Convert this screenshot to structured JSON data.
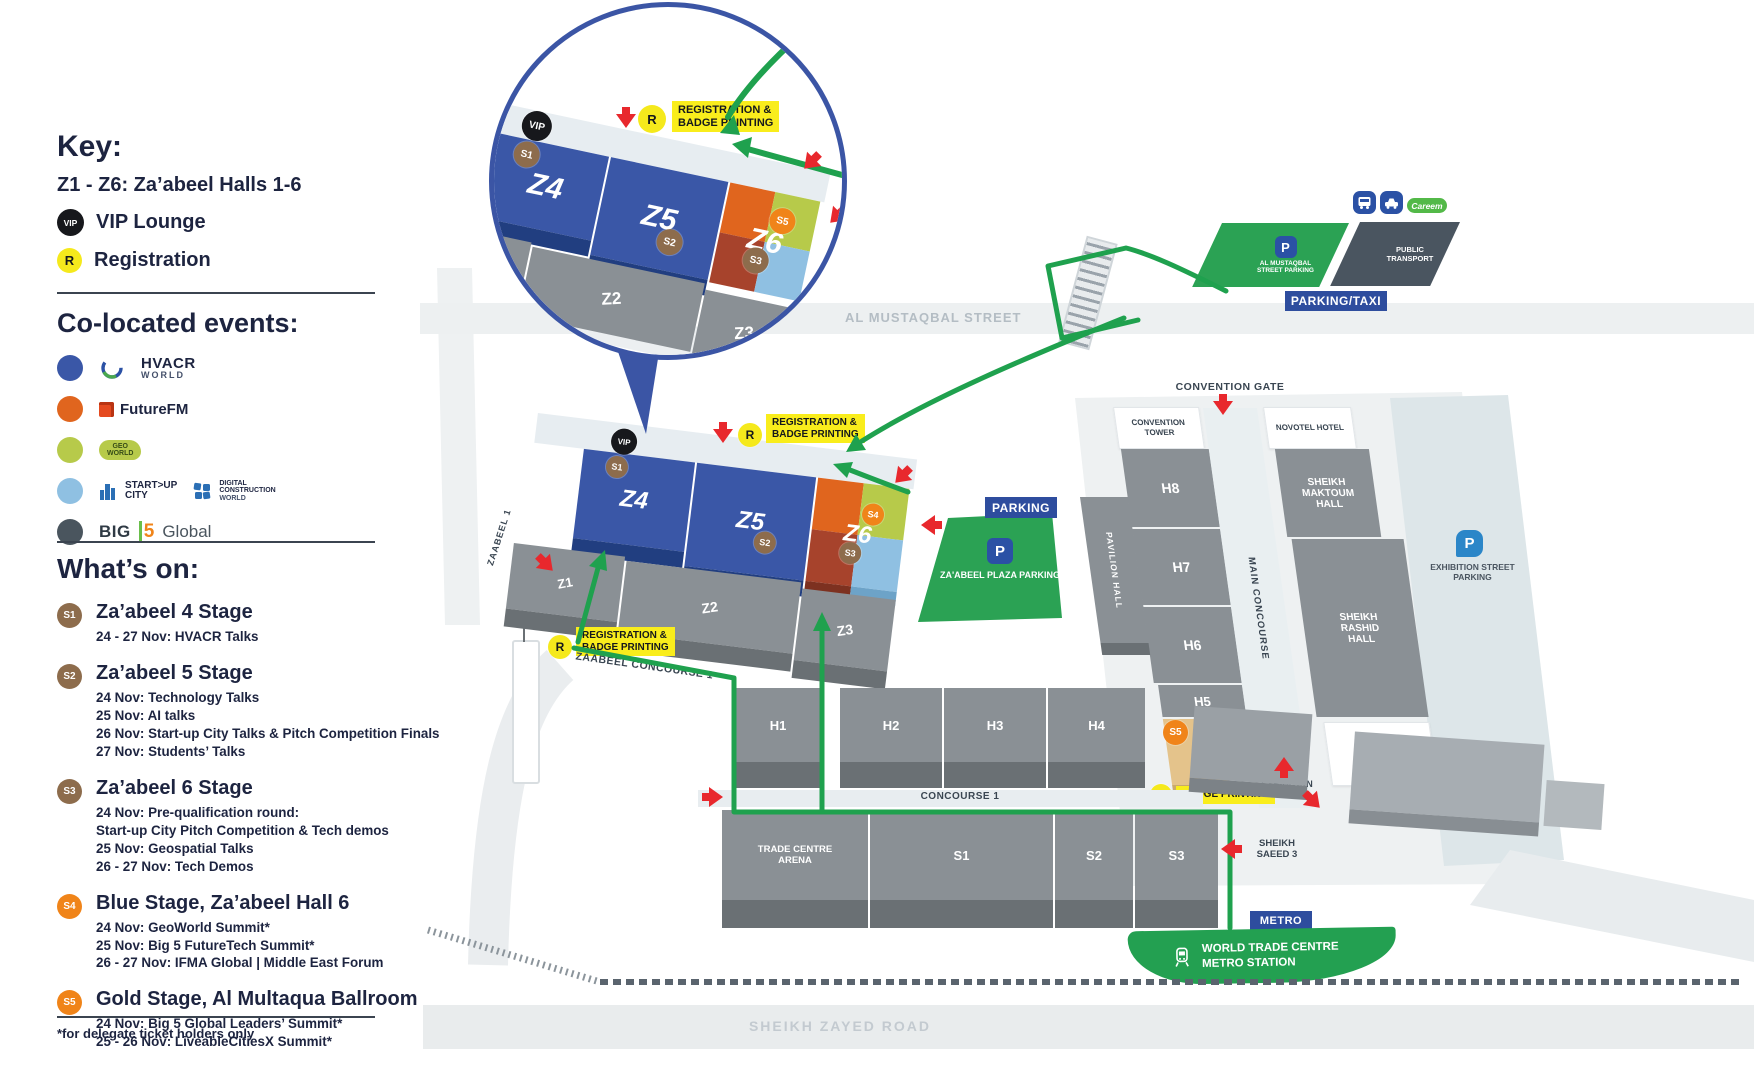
{
  "badges": {
    "vip": "VIP",
    "r": "R",
    "s1": "S1",
    "s2": "S2",
    "s3": "S3",
    "s4": "S4",
    "s5": "S5"
  },
  "colors": {
    "route_green": "#1fa14e",
    "label_yellow": "#f9ed1c",
    "label_blue": "#2e4d9e",
    "hall_blue": "#3a57a7",
    "hall_orange": "#e0651e",
    "hall_lime": "#b7ca4a",
    "hall_rust": "#a7432c",
    "hall_lightblue": "#8fc0e2",
    "hall_gray": "#8a9095",
    "stage_brown": "#8d6c4c",
    "stage_orange": "#f08419",
    "parking_green": "#2ba254"
  },
  "sidebar": {
    "key_title": "Key:",
    "halls_line": "Z1 - Z6:  Za’abeel Halls 1-6",
    "vip_label": "VIP Lounge",
    "registration_label": "Registration",
    "colocated_title": "Co-located events:",
    "events": [
      {
        "id": "hvacr-world",
        "dot": "#3a57a7",
        "line1": "HVACR",
        "line2": "WORLD"
      },
      {
        "id": "futurefm",
        "dot": "#e0651e",
        "line1": "FutureFM"
      },
      {
        "id": "geoworld",
        "dot": "#b7ca4a",
        "line1": "GEO",
        "line2": "WORLD"
      },
      {
        "id": "startup-city-dcw",
        "dot": "#8fc0e2",
        "a1": "START>UP",
        "a2": "CITY",
        "b1": "DIGITAL",
        "b2": "CONSTRUCTION",
        "b3": "WORLD"
      },
      {
        "id": "big5-global",
        "dot": "#4a555e",
        "p1": "BIG",
        "p2": "5",
        "p3": "Global"
      }
    ],
    "whats_on_title": "What’s on:",
    "stages": [
      {
        "badge": "S1",
        "color": "#8d6c4c",
        "title": "Za’abeel 4 Stage",
        "lines": [
          "24 - 27 Nov: HVACR Talks"
        ]
      },
      {
        "badge": "S2",
        "color": "#8d6c4c",
        "title": "Za’abeel 5 Stage",
        "lines": [
          "24 Nov: Technology Talks",
          "25 Nov: AI talks",
          "26 Nov: Start-up City Talks & Pitch Competition Finals",
          "27 Nov: Students’ Talks"
        ]
      },
      {
        "badge": "S3",
        "color": "#8d6c4c",
        "title": "Za’abeel 6 Stage",
        "lines": [
          "24 Nov: Pre-qualification round:",
          "Start-up City Pitch Competition & Tech demos",
          "25 Nov: Geospatial Talks",
          "26 - 27 Nov: Tech Demos"
        ]
      },
      {
        "badge": "S4",
        "color": "#f08419",
        "title": "Blue Stage, Za’abeel Hall 6",
        "lines": [
          "24 Nov: GeoWorld Summit*",
          "25 Nov: Big 5 FutureTech Summit*",
          "26 - 27 Nov: IFMA Global | Middle East Forum"
        ]
      },
      {
        "badge": "S5",
        "color": "#f08419",
        "title": "Gold Stage, Al Multaqua Ballroom",
        "lines": [
          "24 Nov: Big 5 Global Leaders’ Summit*",
          "25 - 26 Nov: LiveableCitiesX Summit*"
        ]
      }
    ],
    "footnote": "*for delegate ticket holders only"
  },
  "map": {
    "streets": {
      "al_mustaqbal": "AL MUSTAQBAL STREET",
      "sheikh_zayed": "SHEIKH ZAYED ROAD",
      "zaabeel_1": "ZAABEEL 1",
      "zaabeel_concourse_1": "ZAABEEL CONCOURSE 1",
      "concourse_1": "CONCOURSE 1",
      "main_concourse": "MAIN CONCOURSE",
      "sheikh_saeed_3": "SHEIKH SAEED 3"
    },
    "gates": {
      "convention": "CONVENTION GATE",
      "exhibition": "EXHIBITION GATE"
    },
    "labels": {
      "reg_line1": "REGISTRATION &",
      "reg_line2": "BADGE PRINTING",
      "badge_printing": "BADGE PRINTING",
      "parking": "PARKING",
      "parking_taxi": "PARKING/TAXI",
      "metro": "METRO",
      "p": "P"
    },
    "halls": {
      "z1": "Z1",
      "z2": "Z2",
      "z3": "Z3",
      "z4": "Z4",
      "z5": "Z5",
      "z6": "Z6",
      "h1": "H1",
      "h2": "H2",
      "h3": "H3",
      "h4": "H4",
      "h5": "H5",
      "h6": "H6",
      "h7": "H7",
      "h8": "H8",
      "s1": "S1",
      "s2": "S2",
      "s3": "S3",
      "trade_centre_arena": "TRADE CENTRE ARENA",
      "pavilion_hall": "PAVILION HALL",
      "sheikh_maktoum_hall": "SHEIKH MAKTOUM HALL",
      "sheikh_rashid_hall": "SHEIKH RASHID HALL"
    },
    "buildings": {
      "convention_tower": "CONVENTION TOWER",
      "novotel_hotel": "NOVOTEL HOTEL",
      "ibis_hotel": "IBIS HOTEL"
    },
    "parking": {
      "al_mustaqbal_street_parking": "AL MUSTAQBAL STREET PARKING",
      "zaabeel_plaza_parking": "ZA'ABEEL PLAZA PARKING",
      "exhibition_street_parking": "EXHIBITION STREET PARKING",
      "public_transport": "PUBLIC TRANSPORT",
      "careem": "Careem"
    },
    "metro_station": "WORLD TRADE CENTRE METRO STATION"
  }
}
